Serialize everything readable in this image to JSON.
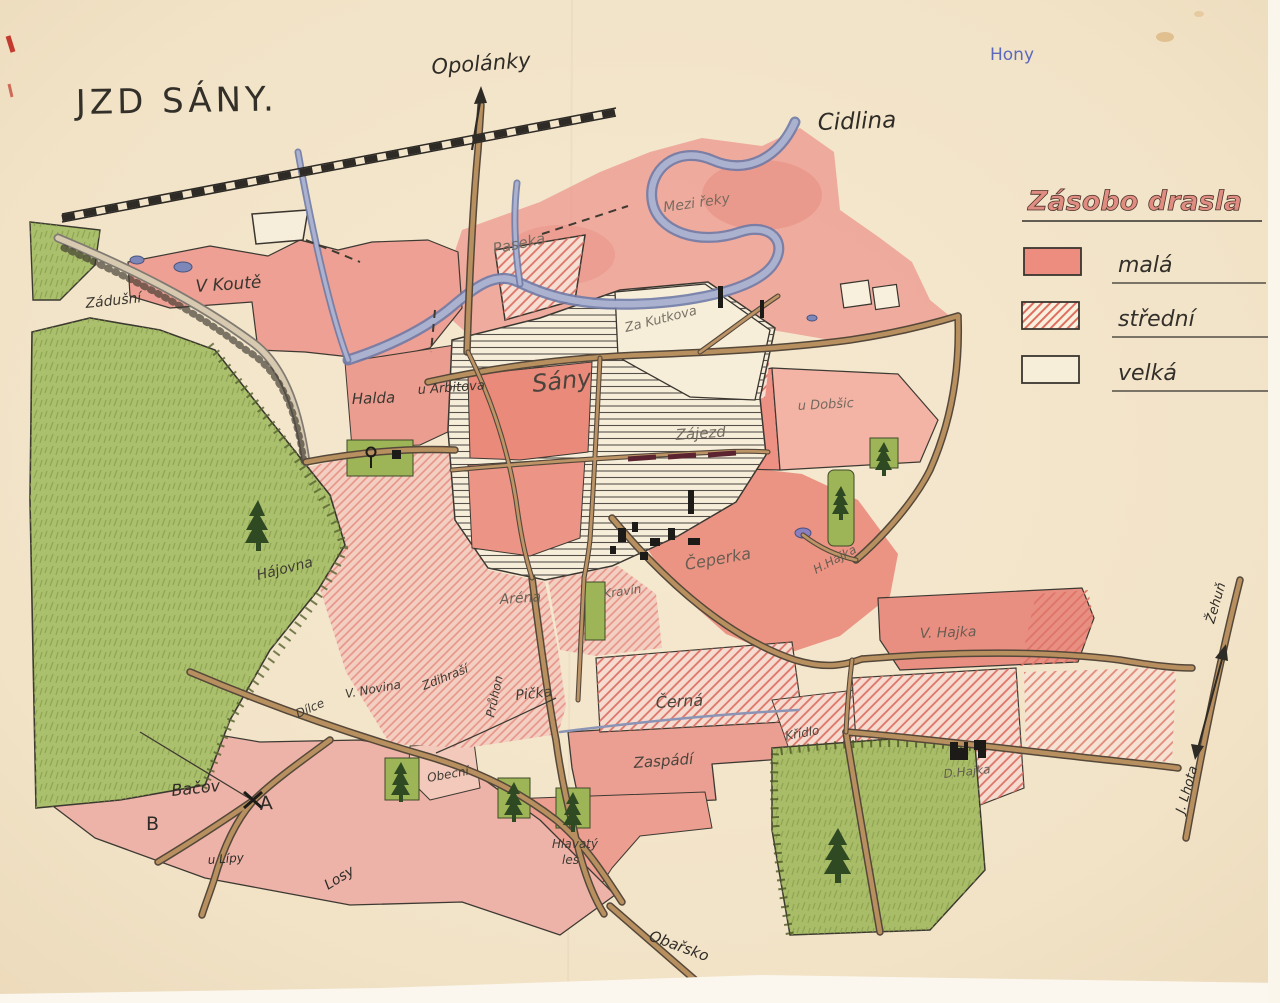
{
  "map": {
    "title": "JZD SÁNY.",
    "note_blue": "Hony",
    "river_name": "Cidlina",
    "directions": {
      "north": "Opolánky",
      "east_up": "Žehuň",
      "east_down": "J. Lhota",
      "south": "Obařsko"
    },
    "places": {
      "zadusni": "Zádušní",
      "vKoute": "V Koutě",
      "paseka": "Paseka",
      "meziReky": "Mezi řeky",
      "zaKutkova": "Za Kutkova",
      "halda": "Halda",
      "uArbitova": "u Arbitova",
      "sany": "Sány",
      "zajezd": "Zájezd",
      "uDobsic": "u Dobšic",
      "ceperka": "Čeperka",
      "hHajka": "H.Hajka",
      "kravin": "Kravín",
      "hajovna": "Hájovna",
      "arena": "Aréna",
      "dilce": "Dílce",
      "vNovina": "V. Novina",
      "zdihrasi": "Zdihraší",
      "pruhon": "Průhon",
      "picka": "Pička",
      "cerna": "Černá",
      "kridlo": "Křídlo",
      "zaspadi": "Zaspádí",
      "obecni": "Obecní",
      "bacov": "Bačov",
      "markA": "A",
      "markB": "B",
      "uLipy": "u Lípy",
      "losy": "Losy",
      "hlavatyLes1": "Hlavatý",
      "hlavatyLes2": "les",
      "vHajka": "V. Hajka",
      "dHajka": "D.Hajka"
    }
  },
  "legend": {
    "title": "Zásobo drasla",
    "items": [
      {
        "label": "malá",
        "style": "solid",
        "color": "#ed8d80"
      },
      {
        "label": "střední",
        "style": "hatched",
        "color": "#e0796c"
      },
      {
        "label": "velká",
        "style": "empty",
        "color": "#f7eeda"
      }
    ]
  },
  "palette": {
    "paper": "#f2e4c9",
    "forest": "#abc06c",
    "river": "#a6aecb",
    "road": "#b8905f",
    "ink": "#3a362f"
  }
}
